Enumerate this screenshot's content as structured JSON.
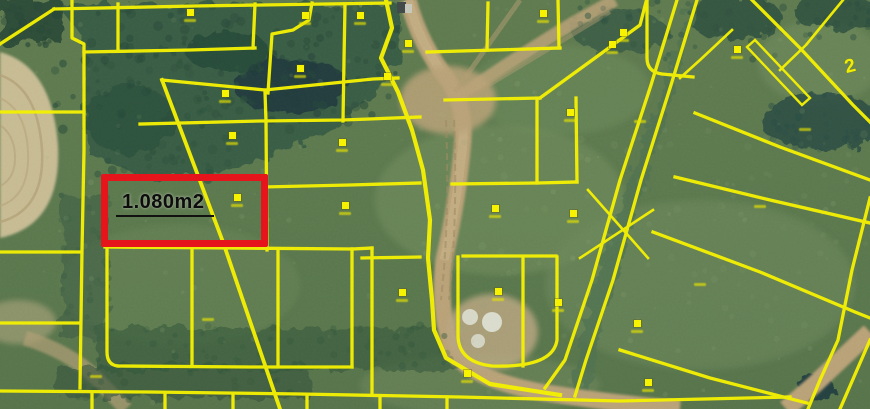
{
  "map": {
    "colors": {
      "parcel_line": "#f3ef04",
      "marker": "#f6f200",
      "highlight_border": "#e6151c",
      "label_text": "#0d0d0d"
    },
    "highlight": {
      "area_label": "1.080m2",
      "x": 101,
      "y": 174,
      "width": 167,
      "height": 73,
      "border_color": "#e6151c"
    },
    "corner_glyph": {
      "text": "2",
      "x": 845,
      "y": 56
    },
    "markers": [
      {
        "x": 190,
        "y": 12
      },
      {
        "x": 305,
        "y": 15
      },
      {
        "x": 360,
        "y": 15
      },
      {
        "x": 543,
        "y": 13
      },
      {
        "x": 612,
        "y": 44
      },
      {
        "x": 737,
        "y": 49
      },
      {
        "x": 623,
        "y": 32
      },
      {
        "x": 300,
        "y": 68
      },
      {
        "x": 387,
        "y": 76
      },
      {
        "x": 225,
        "y": 93
      },
      {
        "x": 408,
        "y": 43
      },
      {
        "x": 232,
        "y": 135
      },
      {
        "x": 342,
        "y": 142
      },
      {
        "x": 570,
        "y": 112
      },
      {
        "x": 237,
        "y": 197
      },
      {
        "x": 345,
        "y": 205
      },
      {
        "x": 495,
        "y": 208
      },
      {
        "x": 573,
        "y": 213
      },
      {
        "x": 402,
        "y": 292
      },
      {
        "x": 498,
        "y": 291
      },
      {
        "x": 558,
        "y": 302
      },
      {
        "x": 637,
        "y": 323
      },
      {
        "x": 467,
        "y": 373
      },
      {
        "x": 648,
        "y": 382
      }
    ],
    "label_smudges": [
      {
        "x": 805,
        "y": 128
      },
      {
        "x": 760,
        "y": 205
      },
      {
        "x": 700,
        "y": 283
      },
      {
        "x": 640,
        "y": 120
      },
      {
        "x": 96,
        "y": 375
      },
      {
        "x": 208,
        "y": 318
      }
    ]
  }
}
